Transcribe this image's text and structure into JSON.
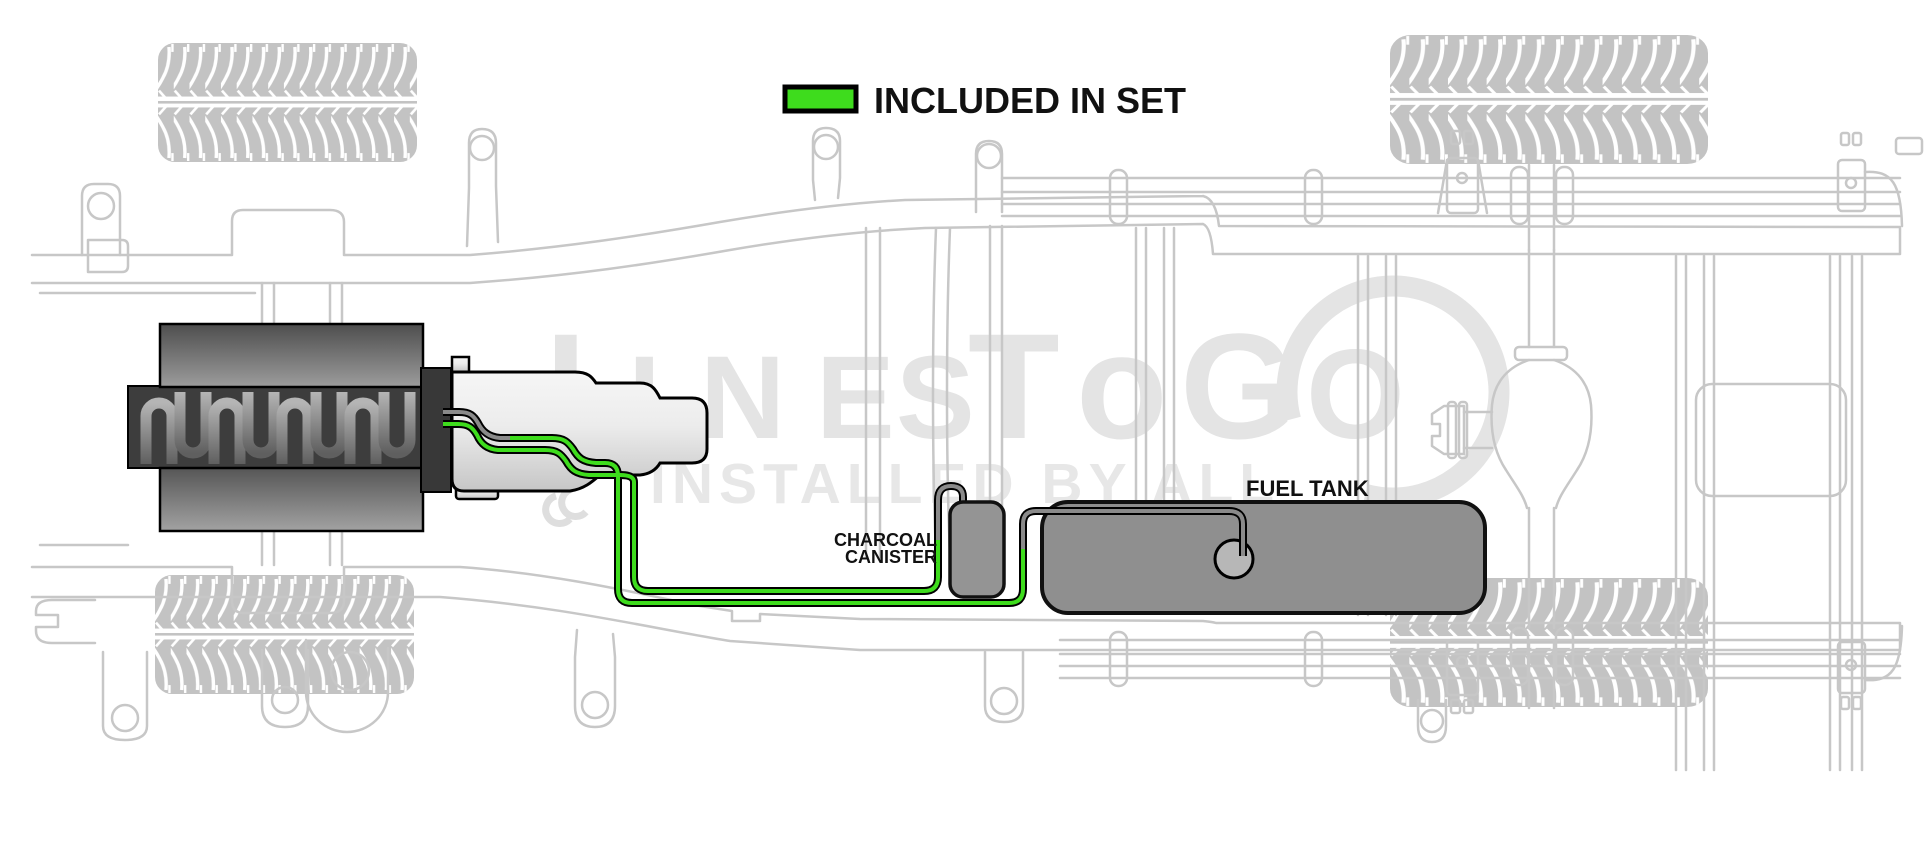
{
  "legend": {
    "label": "INCLUDED IN SET"
  },
  "labels": {
    "fuel_tank": "FUEL TANK",
    "canister_line1": "CHARCOAL",
    "canister_line2": "CANISTER"
  },
  "watermark": {
    "letters": [
      "L",
      "I",
      "N",
      "E",
      "S",
      "T",
      "o",
      "G",
      "O"
    ],
    "tagline": "INSTALLED BY ALL"
  },
  "colors": {
    "included": "#3edc1d",
    "not_included": "#8a8a8a",
    "frame": "#c7c7c7",
    "watermark": "#e4e4e4",
    "tank": "#8f8f8f",
    "canister": "#949494",
    "sender": "#b7b7b7",
    "label_text": "#111111"
  }
}
